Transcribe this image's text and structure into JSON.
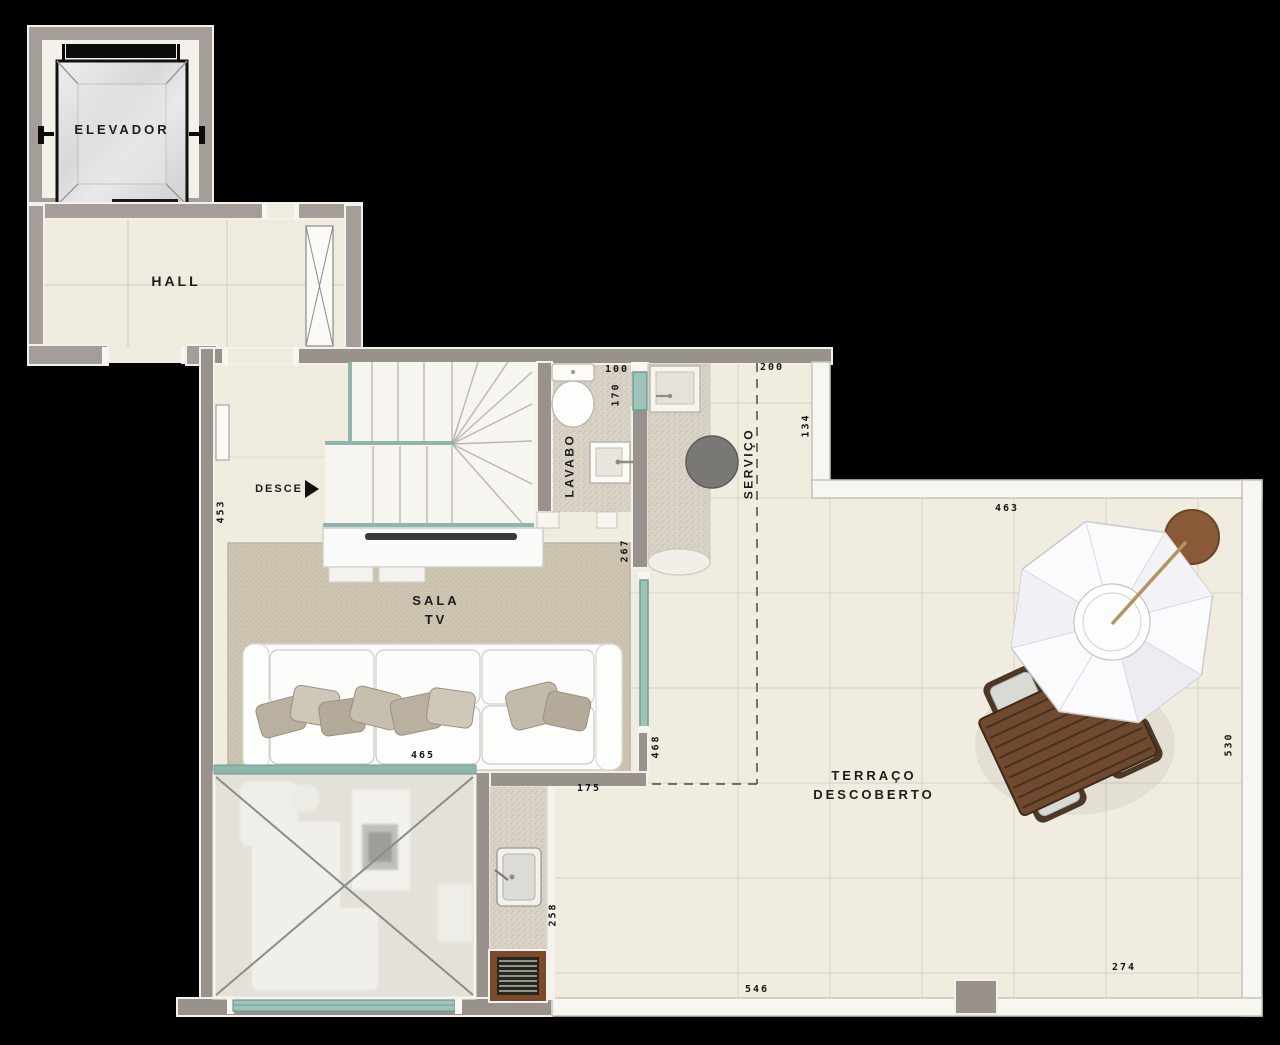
{
  "plan_title": "Upper floor plan with elevator, hall, TV room, lavatory, service area and open terrace",
  "rooms": {
    "elevador": {
      "label": "ELEVADOR"
    },
    "hall": {
      "label": "HALL"
    },
    "stairs": {
      "direction_label": "DESCE"
    },
    "sala_tv": {
      "label_line1": "SALA",
      "label_line2": "TV"
    },
    "lavabo": {
      "label": "LAVABO"
    },
    "servico": {
      "label": "SERVIÇO"
    },
    "terraco": {
      "label_line1": "TERRAÇO",
      "label_line2": "DESCOBERTO"
    }
  },
  "dimensions": {
    "d453": "453",
    "d100": "100",
    "d170": "170",
    "d200": "200",
    "d134": "134",
    "d267": "267",
    "d463": "463",
    "d465": "465",
    "d468": "468",
    "d175": "175",
    "d258": "258",
    "d530": "530",
    "d546": "546",
    "d274": "274"
  },
  "furniture_icons": [
    "sofa",
    "throw-pillows",
    "rug",
    "tv-cabinet",
    "staircase-down",
    "glass-railing",
    "toilet",
    "wall-sink",
    "laundry-tank",
    "water-heater",
    "service-counter",
    "bbq-sink",
    "charcoal-grill",
    "patio-umbrella",
    "umbrella-base",
    "patio-table",
    "patio-chairs",
    "double-height-void",
    "ghost-living-set",
    "pivot-entry-door"
  ],
  "colors": {
    "background": "#000000",
    "walls_main": "#98918c",
    "walls_hall": "#a49d99",
    "wall_outline": "#f2f1ec",
    "parapet_white": "#f7f6f1",
    "floor_cream": "#f0ecdf",
    "grout": "#d5d1c2",
    "rug_beige": "#cdc5b1",
    "granite": "#d9d3c7",
    "glass_teal": "#8fb6ac",
    "wood_table": "#6f4930",
    "grill_frame": "#7b4a2b",
    "umbrella_base_brown": "#8a5a38",
    "label_text": "#1c1c1c"
  }
}
